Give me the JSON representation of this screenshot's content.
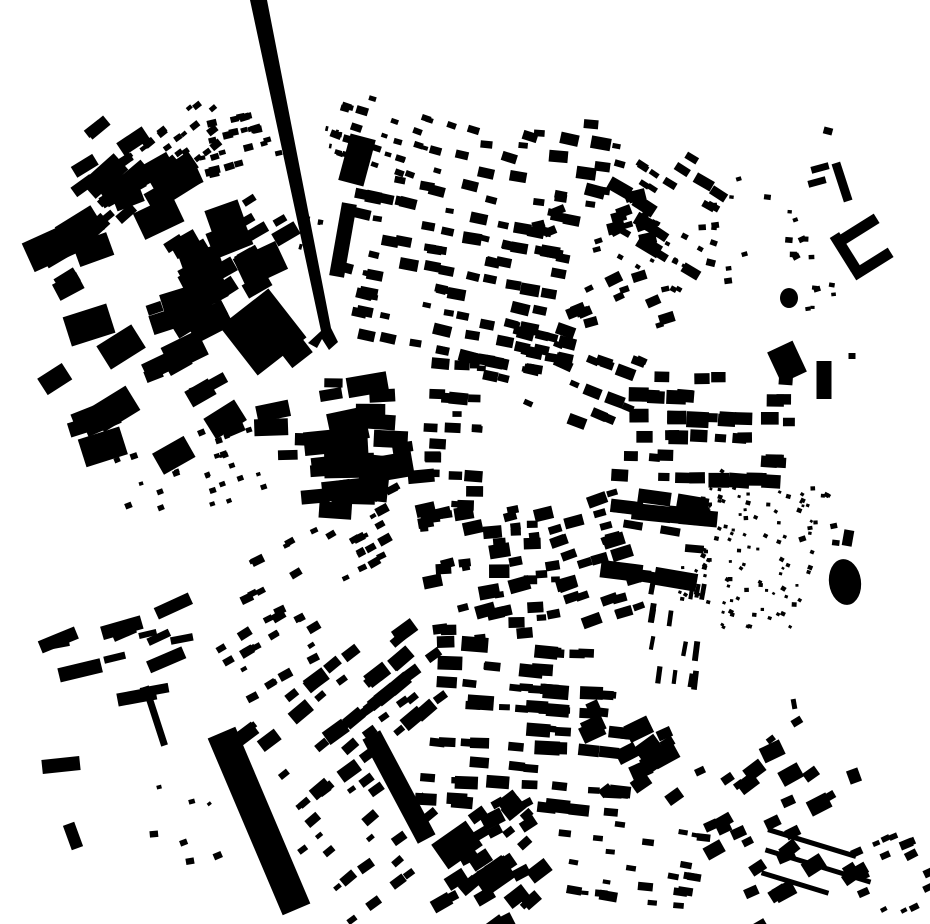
{
  "map": {
    "canvas": {
      "width": 930,
      "height": 924,
      "background": "#ffffff",
      "ink": "#000000"
    },
    "seed": 20,
    "features": [
      {
        "name": "railway-viaduct",
        "kind": "polygon",
        "points": "250,0 267,0 331,328 338,342 329,350 322,339 317,348 308,343 321,331"
      },
      {
        "name": "station-building",
        "kind": "rect",
        "cx": 343,
        "cy": 240,
        "w": 15,
        "h": 74,
        "angle": 10
      },
      {
        "name": "north-block",
        "kind": "rect",
        "cx": 357,
        "cy": 160,
        "w": 26,
        "h": 48,
        "angle": 15
      },
      {
        "name": "works-building",
        "kind": "rect",
        "cx": 263,
        "cy": 332,
        "w": 62,
        "h": 62,
        "angle": -38
      },
      {
        "name": "works-annex",
        "kind": "rect",
        "cx": 297,
        "cy": 353,
        "w": 26,
        "h": 18,
        "angle": -38
      },
      {
        "name": "goods-shed-bar",
        "kind": "rect",
        "cx": 259,
        "cy": 821,
        "w": 30,
        "h": 192,
        "angle": -23
      },
      {
        "name": "dark-terrace-band",
        "kind": "rect",
        "cx": 399,
        "cy": 787,
        "w": 20,
        "h": 118,
        "angle": -28
      },
      {
        "name": "gas-holder",
        "kind": "ellipse",
        "cx": 845,
        "cy": 582,
        "rx": 16,
        "ry": 23,
        "angle": -8
      },
      {
        "name": "east-slab",
        "kind": "rect",
        "cx": 824,
        "cy": 380,
        "w": 15,
        "h": 38,
        "angle": 0
      },
      {
        "name": "central-block-a",
        "kind": "rect",
        "cx": 348,
        "cy": 426,
        "w": 38,
        "h": 32,
        "angle": -12
      },
      {
        "name": "central-block-b",
        "kind": "rect",
        "cx": 374,
        "cy": 478,
        "w": 30,
        "h": 46,
        "angle": 6
      },
      {
        "name": "courtyard-building-north",
        "kind": "rect",
        "cx": 858,
        "cy": 230,
        "w": 44,
        "h": 11,
        "angle": -32
      },
      {
        "name": "courtyard-building-west",
        "kind": "rect",
        "cx": 845,
        "cy": 252,
        "w": 11,
        "h": 40,
        "angle": -32
      },
      {
        "name": "courtyard-building-south",
        "kind": "rect",
        "cx": 872,
        "cy": 264,
        "w": 44,
        "h": 11,
        "angle": -32
      },
      {
        "name": "bracket-bar-1",
        "kind": "rect",
        "cx": 820,
        "cy": 168,
        "w": 18,
        "h": 7,
        "angle": -15
      },
      {
        "name": "bracket-bar-2",
        "kind": "rect",
        "cx": 817,
        "cy": 182,
        "w": 18,
        "h": 7,
        "angle": -15
      },
      {
        "name": "bracket-column",
        "kind": "rect",
        "cx": 842,
        "cy": 182,
        "w": 9,
        "h": 40,
        "angle": -18
      },
      {
        "name": "northeast-blob",
        "kind": "rect",
        "cx": 787,
        "cy": 362,
        "w": 28,
        "h": 34,
        "angle": -25
      },
      {
        "name": "northeast-round-blob",
        "kind": "ellipse",
        "cx": 789,
        "cy": 298,
        "rx": 9,
        "ry": 10,
        "angle": 0
      },
      {
        "name": "west-warehouse",
        "kind": "rect",
        "cx": 61,
        "cy": 765,
        "w": 38,
        "h": 14,
        "angle": -6
      },
      {
        "name": "thin-lane-row",
        "kind": "rect",
        "cx": 155,
        "cy": 716,
        "w": 7,
        "h": 62,
        "angle": -18
      },
      {
        "name": "southwest-small-bar",
        "kind": "rect",
        "cx": 73,
        "cy": 836,
        "w": 12,
        "h": 26,
        "angle": -20
      },
      {
        "name": "southeast-terrace-row-1",
        "kind": "rect",
        "cx": 812,
        "cy": 843,
        "w": 92,
        "h": 5,
        "angle": 17
      },
      {
        "name": "southeast-terrace-row-2",
        "kind": "rect",
        "cx": 818,
        "cy": 866,
        "w": 110,
        "h": 5,
        "angle": 17
      },
      {
        "name": "southeast-terrace-row-3",
        "kind": "rect",
        "cx": 795,
        "cy": 883,
        "w": 70,
        "h": 5,
        "angle": 17
      },
      {
        "name": "south-dark-block-a",
        "kind": "rect",
        "cx": 457,
        "cy": 845,
        "w": 42,
        "h": 30,
        "angle": -35
      },
      {
        "name": "south-dark-block-b",
        "kind": "rect",
        "cx": 494,
        "cy": 876,
        "w": 36,
        "h": 26,
        "angle": -35
      },
      {
        "name": "speck-northeast",
        "kind": "rect",
        "cx": 828,
        "cy": 131,
        "w": 9,
        "h": 7,
        "angle": 15
      },
      {
        "name": "speck-east",
        "kind": "rect",
        "cx": 852,
        "cy": 356,
        "w": 7,
        "h": 6,
        "angle": 0
      },
      {
        "name": "east-small-mark",
        "kind": "rect",
        "cx": 848,
        "cy": 538,
        "w": 10,
        "h": 16,
        "angle": 10
      },
      {
        "name": "east-dash",
        "kind": "rect",
        "cx": 794,
        "cy": 704,
        "w": 5,
        "h": 10,
        "angle": -10
      },
      {
        "name": "southeast-blob",
        "kind": "rect",
        "cx": 854,
        "cy": 776,
        "w": 12,
        "h": 14,
        "angle": -20
      }
    ],
    "clusters": [
      {
        "id": "nw-bars",
        "x": 55,
        "y": 115,
        "w": 110,
        "h": 100,
        "n": 16,
        "s": [
          7,
          22
        ],
        "ar": 2.0,
        "angle": -35,
        "type": "scatter"
      },
      {
        "id": "nw-terrace-a",
        "x": 125,
        "y": 118,
        "w": 105,
        "h": 58,
        "n": 28,
        "s": [
          4,
          8
        ],
        "ar": 1.4,
        "angle": -38,
        "type": "rows",
        "pitch": 14
      },
      {
        "id": "nw-terrace-b",
        "x": 196,
        "y": 110,
        "w": 85,
        "h": 62,
        "n": 24,
        "s": [
          4,
          8
        ],
        "ar": 1.4,
        "angle": -15,
        "type": "rows",
        "pitch": 14
      },
      {
        "id": "railside-dashes",
        "x": 310,
        "y": 108,
        "w": 22,
        "h": 150,
        "n": 10,
        "s": [
          4,
          7
        ],
        "ar": 0.55,
        "angle": 12,
        "type": "rows",
        "pitch": 15
      },
      {
        "id": "north-terrace",
        "x": 330,
        "y": 100,
        "w": 120,
        "h": 75,
        "n": 30,
        "s": [
          4,
          8
        ],
        "ar": 1.5,
        "angle": 18,
        "type": "rows",
        "pitch": 14
      },
      {
        "id": "north-small",
        "x": 455,
        "y": 112,
        "w": 165,
        "h": 90,
        "n": 24,
        "s": [
          5,
          13
        ],
        "ar": 1.6,
        "angle": 10,
        "type": "scatter"
      },
      {
        "id": "ne-rows",
        "x": 620,
        "y": 145,
        "w": 105,
        "h": 115,
        "n": 22,
        "s": [
          5,
          14
        ],
        "ar": 1.8,
        "angle": 32,
        "type": "rows",
        "pitch": 16
      },
      {
        "id": "west-industrial",
        "x": 55,
        "y": 190,
        "w": 200,
        "h": 140,
        "n": 24,
        "s": [
          10,
          32
        ],
        "ar": 1.5,
        "angle": -25,
        "type": "scatter"
      },
      {
        "id": "west-mid-rows",
        "x": 180,
        "y": 205,
        "w": 115,
        "h": 95,
        "n": 24,
        "s": [
          6,
          16
        ],
        "ar": 1.8,
        "angle": -30,
        "type": "rows",
        "pitch": 17
      },
      {
        "id": "west-blobs",
        "x": 58,
        "y": 330,
        "w": 192,
        "h": 140,
        "n": 18,
        "s": [
          10,
          30
        ],
        "ar": 1.5,
        "angle": -25,
        "type": "scatter"
      },
      {
        "id": "west-dot-arc",
        "x": 115,
        "y": 430,
        "w": 150,
        "h": 88,
        "n": 26,
        "s": [
          3,
          6
        ],
        "ar": 1.2,
        "angle": -20,
        "type": "rows",
        "pitch": 15
      },
      {
        "id": "center-north-grid",
        "x": 345,
        "y": 185,
        "w": 215,
        "h": 175,
        "n": 95,
        "s": [
          5,
          12
        ],
        "ar": 1.6,
        "angle": 12,
        "type": "rows",
        "pitch": 19
      },
      {
        "id": "center-ne",
        "x": 555,
        "y": 195,
        "w": 110,
        "h": 150,
        "n": 30,
        "s": [
          5,
          12
        ],
        "ar": 1.5,
        "angle": -20,
        "type": "scatter"
      },
      {
        "id": "ne-dot-rows",
        "x": 625,
        "y": 225,
        "w": 80,
        "h": 60,
        "n": 16,
        "s": [
          3,
          6
        ],
        "ar": 1.2,
        "angle": 30,
        "type": "rows",
        "pitch": 12
      },
      {
        "id": "ne-sparse-dots",
        "x": 700,
        "y": 175,
        "w": 85,
        "h": 110,
        "n": 12,
        "s": [
          3,
          7
        ],
        "ar": 1.3,
        "angle": 0,
        "type": "dots"
      },
      {
        "id": "ne-upper-dots",
        "x": 790,
        "y": 195,
        "w": 50,
        "h": 115,
        "n": 14,
        "s": [
          3,
          6
        ],
        "ar": 1.3,
        "angle": -10,
        "type": "dots"
      },
      {
        "id": "center-left-slabs",
        "x": 270,
        "y": 380,
        "w": 150,
        "h": 140,
        "n": 26,
        "s": [
          8,
          26
        ],
        "ar": 2.0,
        "angle": -4,
        "type": "scatter"
      },
      {
        "id": "square-west-edge",
        "x": 420,
        "y": 358,
        "w": 58,
        "h": 155,
        "n": 22,
        "s": [
          5,
          12
        ],
        "ar": 1.6,
        "angle": 3,
        "type": "rows",
        "pitch": 16
      },
      {
        "id": "square-north-edge",
        "x": 478,
        "y": 325,
        "w": 90,
        "h": 66,
        "n": 20,
        "s": [
          5,
          12
        ],
        "ar": 1.5,
        "angle": 12,
        "type": "rows",
        "pitch": 15
      },
      {
        "id": "center-east-rows",
        "x": 540,
        "y": 335,
        "w": 95,
        "h": 95,
        "n": 20,
        "s": [
          5,
          12
        ],
        "ar": 1.6,
        "angle": 22,
        "type": "rows",
        "pitch": 15
      },
      {
        "id": "east-grid",
        "x": 618,
        "y": 368,
        "w": 175,
        "h": 120,
        "n": 46,
        "s": [
          7,
          16
        ],
        "ar": 1.4,
        "angle": 2,
        "type": "rows",
        "pitch": 21
      },
      {
        "id": "allotment-dots",
        "x": 688,
        "y": 468,
        "w": 125,
        "h": 165,
        "n": 110,
        "s": [
          2.5,
          4.5
        ],
        "ar": 1.1,
        "angle": 15,
        "type": "dots"
      },
      {
        "id": "east-slab-rows",
        "x": 618,
        "y": 490,
        "w": 85,
        "h": 95,
        "n": 16,
        "s": [
          6,
          18
        ],
        "ar": 2.4,
        "angle": 8,
        "type": "rows",
        "pitch": 17
      },
      {
        "id": "se-rows",
        "x": 555,
        "y": 495,
        "w": 80,
        "h": 130,
        "n": 26,
        "s": [
          5,
          13
        ],
        "ar": 1.7,
        "angle": -18,
        "type": "rows",
        "pitch": 15
      },
      {
        "id": "center-south-dense",
        "x": 428,
        "y": 498,
        "w": 130,
        "h": 145,
        "n": 48,
        "s": [
          5,
          14
        ],
        "ar": 1.5,
        "angle": -8,
        "type": "scatter"
      },
      {
        "id": "sw-arc-upper",
        "x": 235,
        "y": 518,
        "w": 190,
        "h": 70,
        "n": 30,
        "s": [
          4,
          9
        ],
        "ar": 1.5,
        "angle": -28,
        "type": "rows",
        "pitch": 15
      },
      {
        "id": "sw-arc-lower",
        "x": 228,
        "y": 615,
        "w": 95,
        "h": 70,
        "n": 20,
        "s": [
          4,
          9
        ],
        "ar": 1.5,
        "angle": -30,
        "type": "rows",
        "pitch": 15
      },
      {
        "id": "west-long-bars",
        "x": 60,
        "y": 600,
        "w": 165,
        "h": 100,
        "n": 13,
        "s": [
          6,
          15
        ],
        "ar": 3.0,
        "angle": -18,
        "type": "scatter"
      },
      {
        "id": "sw-dense",
        "x": 250,
        "y": 655,
        "w": 200,
        "h": 110,
        "n": 46,
        "s": [
          6,
          15
        ],
        "ar": 1.6,
        "angle": -38,
        "type": "rows",
        "pitch": 18
      },
      {
        "id": "sw-lower-rows",
        "x": 295,
        "y": 765,
        "w": 140,
        "h": 135,
        "n": 26,
        "s": [
          4,
          10
        ],
        "ar": 1.6,
        "angle": -38,
        "type": "rows",
        "pitch": 17
      },
      {
        "id": "south-grid",
        "x": 430,
        "y": 640,
        "w": 200,
        "h": 175,
        "n": 70,
        "s": [
          6,
          15
        ],
        "ar": 1.8,
        "angle": 4,
        "type": "rows",
        "pitch": 20
      },
      {
        "id": "south-extra-blocks",
        "x": 585,
        "y": 690,
        "w": 90,
        "h": 110,
        "n": 14,
        "s": [
          8,
          20
        ],
        "ar": 1.4,
        "angle": -30,
        "type": "scatter"
      },
      {
        "id": "south-dense-dark",
        "x": 425,
        "y": 815,
        "w": 135,
        "h": 105,
        "n": 42,
        "s": [
          6,
          16
        ],
        "ar": 1.5,
        "angle": -35,
        "type": "scatter"
      },
      {
        "id": "south-mid-rows",
        "x": 560,
        "y": 820,
        "w": 140,
        "h": 85,
        "n": 24,
        "s": [
          4,
          10
        ],
        "ar": 1.8,
        "angle": 8,
        "type": "rows",
        "pitch": 14
      },
      {
        "id": "se-blocks",
        "x": 700,
        "y": 740,
        "w": 150,
        "h": 170,
        "n": 34,
        "s": [
          6,
          16
        ],
        "ar": 1.4,
        "angle": -30,
        "type": "scatter"
      },
      {
        "id": "se-corner-rows",
        "x": 855,
        "y": 835,
        "w": 75,
        "h": 85,
        "n": 16,
        "s": [
          4,
          9
        ],
        "ar": 1.5,
        "angle": -25,
        "type": "rows",
        "pitch": 13
      },
      {
        "id": "east-bar-trio",
        "x": 645,
        "y": 575,
        "w": 58,
        "h": 115,
        "n": 14,
        "s": [
          13,
          20
        ],
        "ar": 0.3,
        "angle": 8,
        "type": "rows",
        "pitch": 28
      },
      {
        "id": "sw-specks",
        "x": 150,
        "y": 740,
        "w": 75,
        "h": 160,
        "n": 7,
        "s": [
          3,
          8
        ],
        "ar": 1.3,
        "angle": -25,
        "type": "dots"
      },
      {
        "id": "east-mid-specks",
        "x": 800,
        "y": 520,
        "w": 45,
        "h": 40,
        "n": 4,
        "s": [
          3,
          8
        ],
        "ar": 1.3,
        "angle": 0,
        "type": "dots"
      }
    ]
  }
}
